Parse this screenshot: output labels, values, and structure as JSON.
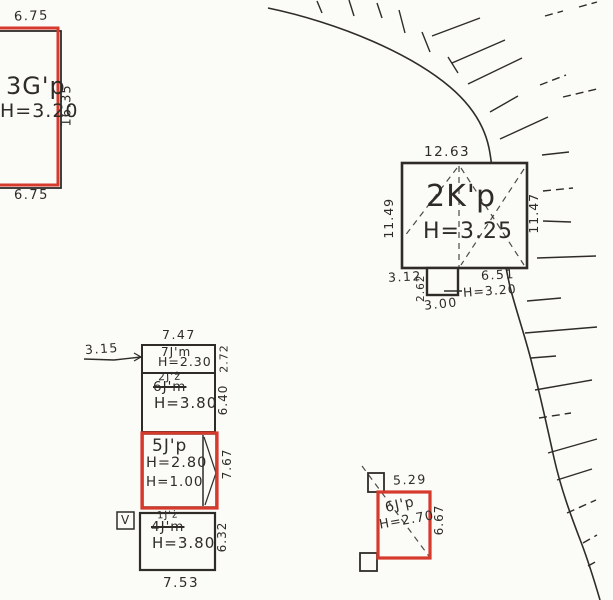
{
  "colors": {
    "ink": "#2f2c28",
    "red": "#d63a2c",
    "paper": "#fbfbf8"
  },
  "buildings": {
    "b3gp": {
      "label": "3G'p",
      "height": "H=3.20",
      "dim_top": "6.75",
      "dim_right": "16.35",
      "dim_bottom": "6.75"
    },
    "b2kp": {
      "label": "2K'p",
      "height": "H=3.25",
      "dim_top": "12.63",
      "dim_left": "11.49",
      "dim_right": "11.47",
      "dim_bottom_left": "3.12",
      "dim_bottom_right": "6.51",
      "annex_dim_side": "2.62",
      "annex_dim_bottom": "3.00",
      "annex_height": "H=3.20"
    },
    "b7jm": {
      "label": "7J'm",
      "height": "H=2.30",
      "dim_top": "7.47",
      "dim_right": "2.72",
      "offset_label": "3.15"
    },
    "b6jm": {
      "label_new": "2J'ż",
      "label_old": "6J'm",
      "height": "H=3.80",
      "dim_right": "6.40"
    },
    "b5jp": {
      "label": "5J'p",
      "height_1": "H=2.80",
      "height_2": "H=1.00",
      "dim_right": "7.67"
    },
    "b4jm": {
      "label_new": "1J'ż",
      "label_old": "4J'm",
      "height": "H=3.80",
      "dim_right": "6.32",
      "dim_bottom": "7.53",
      "marker": "V"
    },
    "b6jp": {
      "label": "6J'p",
      "height": "H=2.70",
      "dim_top": "5.29",
      "dim_right": "6.67"
    }
  },
  "geometry": {
    "slope_path": "M 268 8 C 302 15 340 27 372 41 C 404 55 431 71 450 87 C 470 104 484 124 489 148 C 493 168 494 190 498 220 C 501 245 506 268 510 287 C 518 317 527 342 533 368 C 540 394 547 426 554 458 C 561 489 571 516 581 542 C 589 563 595 583 600 600",
    "hatches": [
      {
        "x1": 317,
        "y1": 1,
        "x2": 322,
        "y2": 13
      },
      {
        "x1": 349,
        "y1": 0,
        "x2": 354,
        "y2": 16
      },
      {
        "x1": 377,
        "y1": 3,
        "x2": 382,
        "y2": 18
      },
      {
        "x1": 399,
        "y1": 10,
        "x2": 405,
        "y2": 33
      },
      {
        "x1": 422,
        "y1": 32,
        "x2": 430,
        "y2": 52
      },
      {
        "x1": 448,
        "y1": 57,
        "x2": 458,
        "y2": 73
      },
      {
        "x1": 432,
        "y1": 36,
        "x2": 480,
        "y2": 18
      },
      {
        "x1": 452,
        "y1": 63,
        "x2": 505,
        "y2": 40
      },
      {
        "x1": 468,
        "y1": 84,
        "x2": 522,
        "y2": 58
      },
      {
        "x1": 490,
        "y1": 112,
        "x2": 518,
        "y2": 96
      },
      {
        "x1": 540,
        "y1": 85,
        "x2": 566,
        "y2": 75,
        "dash": true
      },
      {
        "x1": 500,
        "y1": 139,
        "x2": 548,
        "y2": 117
      },
      {
        "x1": 545,
        "y1": 16,
        "x2": 563,
        "y2": 11,
        "dash": true
      },
      {
        "x1": 579,
        "y1": 7,
        "x2": 597,
        "y2": 2,
        "dash": true
      },
      {
        "x1": 563,
        "y1": 97,
        "x2": 597,
        "y2": 89,
        "dash": true
      },
      {
        "x1": 542,
        "y1": 155,
        "x2": 569,
        "y2": 152
      },
      {
        "x1": 543,
        "y1": 191,
        "x2": 573,
        "y2": 188,
        "dash": true
      },
      {
        "x1": 543,
        "y1": 221,
        "x2": 571,
        "y2": 222
      },
      {
        "x1": 537,
        "y1": 258,
        "x2": 596,
        "y2": 256
      },
      {
        "x1": 527,
        "y1": 301,
        "x2": 561,
        "y2": 298
      },
      {
        "x1": 525,
        "y1": 333,
        "x2": 597,
        "y2": 327
      },
      {
        "x1": 531,
        "y1": 358,
        "x2": 556,
        "y2": 356
      },
      {
        "x1": 535,
        "y1": 390,
        "x2": 592,
        "y2": 380
      },
      {
        "x1": 539,
        "y1": 418,
        "x2": 571,
        "y2": 413,
        "dash": true
      },
      {
        "x1": 548,
        "y1": 453,
        "x2": 597,
        "y2": 439
      },
      {
        "x1": 557,
        "y1": 480,
        "x2": 592,
        "y2": 469
      },
      {
        "x1": 567,
        "y1": 513,
        "x2": 596,
        "y2": 500,
        "dash": true
      },
      {
        "x1": 583,
        "y1": 543,
        "x2": 597,
        "y2": 535,
        "dash": true
      },
      {
        "x1": 588,
        "y1": 566,
        "x2": 599,
        "y2": 560,
        "dash": true
      }
    ],
    "black_rects": [
      {
        "name": "b3gp-base",
        "x": -8,
        "y": 31,
        "w": 69,
        "h": 157,
        "sw": 1.8
      },
      {
        "name": "b2kp-main",
        "x": 402,
        "y": 163,
        "w": 125,
        "h": 105,
        "sw": 2.6
      },
      {
        "name": "b2kp-annex",
        "x": 427,
        "y": 268,
        "w": 31,
        "h": 27,
        "sw": 2.4
      },
      {
        "name": "b7jm-outline",
        "x": 142,
        "y": 345,
        "w": 73,
        "h": 28,
        "sw": 2
      },
      {
        "name": "b6jm-outline",
        "x": 142,
        "y": 373,
        "w": 73,
        "h": 59,
        "sw": 2
      },
      {
        "name": "b5jp-base",
        "x": 143,
        "y": 434,
        "w": 73,
        "h": 73,
        "sw": 1.5
      },
      {
        "name": "b4jm-outline",
        "x": 140,
        "y": 513,
        "w": 75,
        "h": 57,
        "sw": 2.2
      },
      {
        "name": "v-marker-box",
        "x": 117,
        "y": 512,
        "w": 17,
        "h": 17,
        "sw": 1.5
      },
      {
        "name": "b6jp-square-top",
        "x": 368,
        "y": 473,
        "w": 16,
        "h": 19,
        "sw": 1.8
      },
      {
        "name": "b6jp-square-bottom",
        "x": 360,
        "y": 553,
        "w": 17,
        "h": 18,
        "sw": 1.8
      }
    ],
    "dashed_lines": [
      {
        "name": "b2kp-ridge-vertical",
        "x1": 459,
        "y1": 166,
        "x2": 459,
        "y2": 267
      },
      {
        "name": "b2kp-roof-diagonal-1",
        "x1": 461,
        "y1": 168,
        "x2": 524,
        "y2": 265
      },
      {
        "name": "b2kp-roof-diagonal-2",
        "x1": 524,
        "y1": 169,
        "x2": 461,
        "y2": 265
      },
      {
        "name": "b2kp-roof-diagonal-left",
        "x1": 457,
        "y1": 168,
        "x2": 404,
        "y2": 237
      },
      {
        "name": "b6jp-diagonal",
        "x1": 362,
        "y1": 466,
        "x2": 431,
        "y2": 559
      }
    ],
    "solid_lines": [
      {
        "name": "offset-leader-underline",
        "x1": 84,
        "y1": 359,
        "x2": 114,
        "y2": 360,
        "sw": 1.6
      },
      {
        "name": "offset-leader",
        "x1": 114,
        "y1": 360,
        "x2": 141,
        "y2": 357,
        "sw": 1.4
      },
      {
        "name": "offset-leader-arrow-a",
        "x1": 134,
        "y1": 353,
        "x2": 141,
        "y2": 357,
        "sw": 1.2
      },
      {
        "name": "offset-leader-arrow-b",
        "x1": 134,
        "y1": 361,
        "x2": 141,
        "y2": 357,
        "sw": 1.2
      },
      {
        "name": "annex-height-leader",
        "x1": 444,
        "y1": 291,
        "x2": 462,
        "y2": 291,
        "sw": 1.4
      },
      {
        "name": "b5jp-strip-line",
        "x1": 203,
        "y1": 435,
        "x2": 203,
        "y2": 506,
        "sw": 1.5
      },
      {
        "name": "b5jp-strip-chevron-a",
        "x1": 204,
        "y1": 437,
        "x2": 216,
        "y2": 473,
        "sw": 1.2
      },
      {
        "name": "b5jp-strip-chevron-b",
        "x1": 216,
        "y1": 473,
        "x2": 205,
        "y2": 505,
        "sw": 1.2
      }
    ],
    "red_rects": [
      {
        "name": "b3gp-red-outline",
        "x": -10,
        "y": 28,
        "w": 68,
        "h": 157,
        "sw": 3
      },
      {
        "name": "b5jp-red-outline",
        "x": 142,
        "y": 433,
        "w": 75,
        "h": 75,
        "sw": 3.2
      },
      {
        "name": "b6jp-red-outline",
        "x": 378,
        "y": 492,
        "w": 52,
        "h": 66,
        "sw": 3.2
      }
    ]
  }
}
